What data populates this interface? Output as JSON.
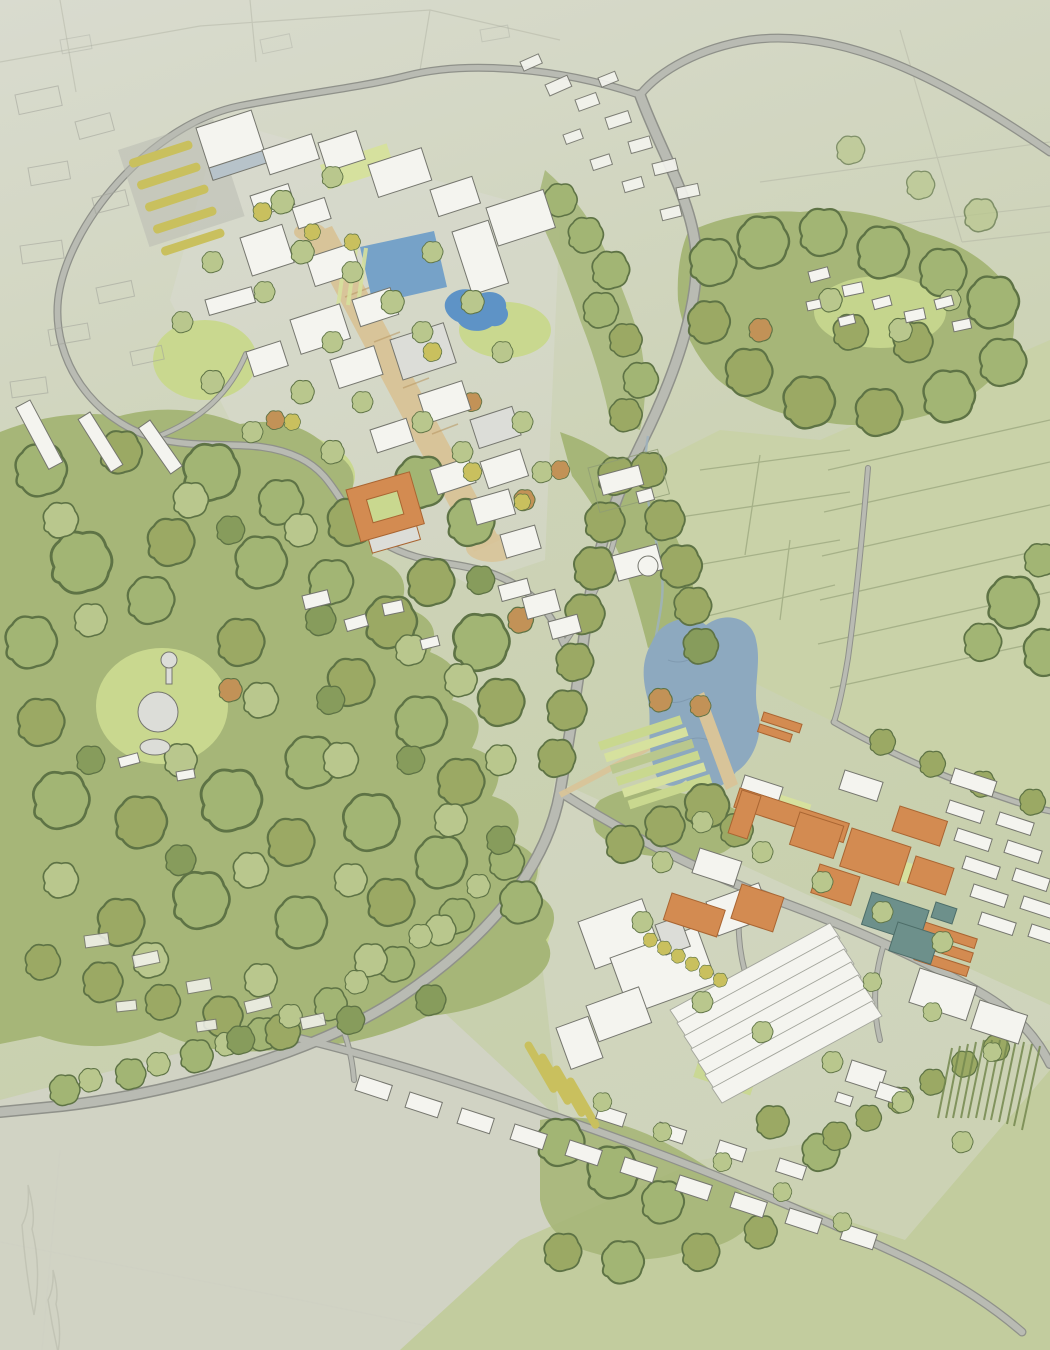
{
  "scene": {
    "kind": "watercolour-aerial-masterplan",
    "view": "oblique birds-eye view of a wooded research campus and village",
    "visible_text": "none"
  },
  "features": {
    "upper_campus": "Upper campus cluster of white research buildings around a landscaped pedestrian spine",
    "glass_building": "Large four-storey building with glazed facade beside tree-lined car park",
    "parking_tree_rows": "Car park rows planted with yellow-green trees",
    "formal_pond": "Rectangular formal pond with terraced green steps",
    "organic_pond": "Small organic-shaped pond among trees",
    "pedestrian_spine": "Tan paved stepped spine running through the upper campus",
    "orange_courtyard_building": "Orange-roofed courtyard building in the woods",
    "manor_house": "Manor house with hedged garden east of the campus",
    "water_tower": "Round water tower and tanks in a woodland clearing",
    "central_woodland": "Large central belt of mature broadleaf woodland",
    "northeast_woodland": "Woodland block with a small hamlet clearing",
    "village_strip": "Lightly sketched village houses along the top road",
    "main_avenue": "Tree-lined avenue curving from the village past the lake to the south-west",
    "highway": "Road crossing the open fields to the top right",
    "field_lane": "Narrow lane between hedged pastures on the right",
    "hedged_fields": "Pale green pastures divided by pencil hedgerow lines",
    "lake": "Irregular blue lake with a timber boardwalk jetty",
    "boardwalk": "Tan boardwalk path leading across the lake",
    "allotment_terraces": "Terraced green allotment strips below the lake",
    "lower_campus": "Lower campus with large white laboratory complex",
    "hq_complex": "Large white multi-wing headquarters building",
    "greenhouse_rows": "Block of long parallel white greenhouse sheds",
    "orange_roof_cluster": "Cluster of orange-roofed institute buildings",
    "teal_roof_building": "Slate-teal roofed building group",
    "terrace_rows": "Rows of small white terraced blocks on the east edge",
    "orchard_rows": "Rows of yellow-green orchard planting",
    "crop_rows": "Striped crop field rows in the south-east",
    "bottom_street": "Lower street lined with small houses and sheds",
    "stream": "Small stream running beside the avenue",
    "faded_suburb": "Faded pencil-sketched suburb at the upper left",
    "bottom_left_hamlet": "Faint hamlet along the lower-left road"
  },
  "palette": {
    "paper_top": "#d9dbcf",
    "paper_mid": "#cdd3b7",
    "paper_green": "#c6cfa9",
    "corner_pale": "#d1d3c6",
    "field_right": "#c9d2a8",
    "field_bottom": "#c2cc9e",
    "sketch": "#a9ab9c",
    "hedge": "#8f9c74",
    "crop": "#75894f",
    "wood_base": "#a6b678",
    "canopy_light": "#b9c78d",
    "canopy_mid": "#a2b574",
    "canopy_olive": "#9ba964",
    "canopy_dark": "#879c5c",
    "canopy_stroke": "#5e7345",
    "lawn": "#c9d88f",
    "lawn_bright": "#d6e19e",
    "lake": "#8da9bf",
    "lake_edge": "#71899f",
    "pond": "#76a2c8",
    "pond2": "#5e93c6",
    "stream_blue": "#9db3c0",
    "road": "#b9bbb3",
    "road_edge": "#8f918a",
    "path_tan": "#d8c499",
    "path_tan_dark": "#b99a66",
    "bldg": "#f4f4ef",
    "bldg_grey": "#dcddd8",
    "bldg_stroke": "#75766e",
    "faded_stroke": "#a3a59c",
    "glass": "#b7c3ca",
    "orange": "#d38b51",
    "orange_dark": "#a96532",
    "teal": "#6d908b",
    "teal_dark": "#4d6d68",
    "yellow_tree": "#c9c05e",
    "autumn": "#c29257"
  }
}
